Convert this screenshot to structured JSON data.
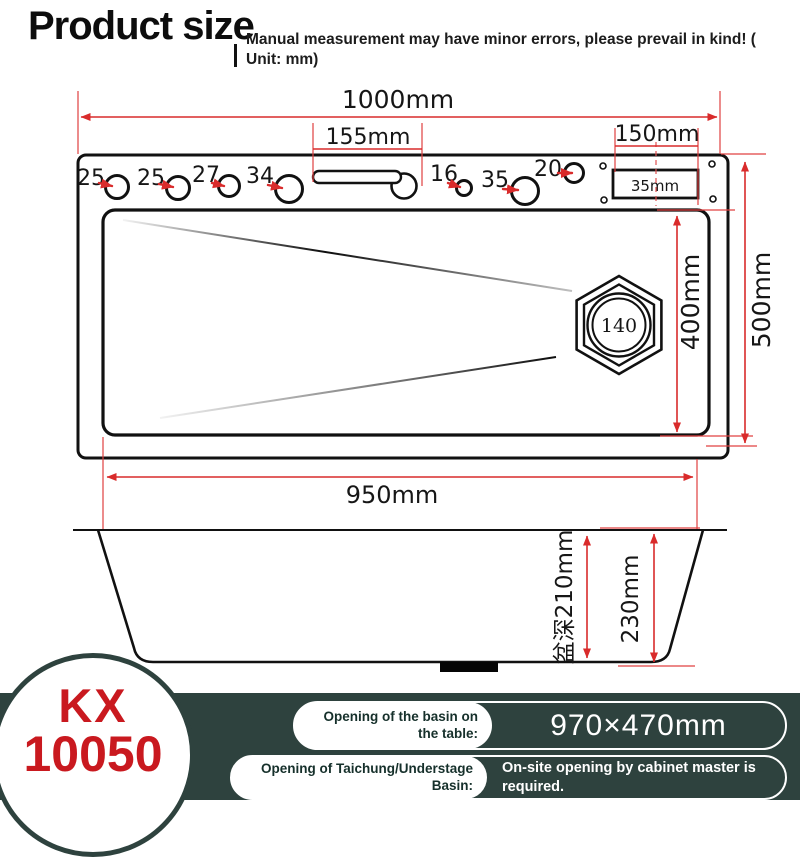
{
  "header": {
    "title": "Product size",
    "disclaimer": "Manual measurement may have minor errors, please prevail in kind! ( Unit: mm)"
  },
  "top_view": {
    "dim_total_width": "1000mm",
    "dim_faucet_slot": "155mm",
    "dim_right_section": "150mm",
    "overflow_box_label": "35mm",
    "holes": [
      "25",
      "25",
      "27",
      "34",
      "16",
      "35",
      "20"
    ],
    "drain_label": "140",
    "dim_inner_depth": "400mm",
    "dim_total_depth": "500mm"
  },
  "side_view": {
    "dim_bottom_width": "950mm",
    "dim_basin_depth": "盆深210mm",
    "dim_overall_height": "230mm"
  },
  "footer": {
    "model_top": "KX",
    "model_bottom": "10050",
    "rows": [
      {
        "label": "Opening of the basin on the table:",
        "value": "970×470mm"
      },
      {
        "label": "Opening of Taichung/Understage Basin:",
        "value": "On-site opening by cabinet master is required."
      }
    ]
  },
  "colors": {
    "dimension_red": "#d92b2b",
    "panel_green": "#2e423e",
    "model_red": "#c9191f"
  }
}
